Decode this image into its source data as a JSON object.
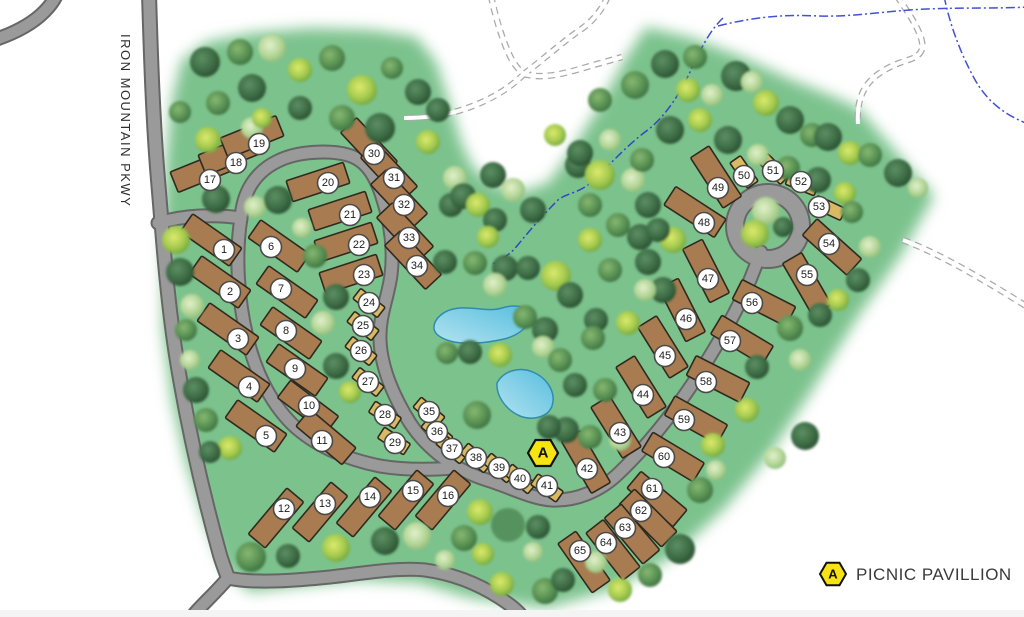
{
  "road_label": "IRON MOUNTAIN PKWY",
  "legend": {
    "letter": "A",
    "label": "PICNIC PAVILLION"
  },
  "pavilion": {
    "letter": "A",
    "x": 543,
    "y": 453
  },
  "colors": {
    "ground_green": "#7cc28d",
    "road_fill": "#9a9a9a",
    "road_casing": "#666666",
    "rv_site": "#a87c50",
    "tent_site": "#d9b964",
    "site_outline": "#2f2a20",
    "pond_fill": "#6fc8e4",
    "pond_edge": "#2f8cb0",
    "stream_blue": "#2233cc",
    "marker_yellow": "#f6e313",
    "badge_fill": "#ffffff",
    "badge_edge": "#4a4a4a"
  },
  "sites": [
    [
      1,
      211,
      240,
      35,
      "rv",
      224,
      250
    ],
    [
      2,
      220,
      282,
      35,
      "rv",
      230,
      292
    ],
    [
      3,
      228,
      329,
      35,
      "rv",
      238,
      339
    ],
    [
      4,
      239,
      376,
      35,
      "rv",
      249,
      387
    ],
    [
      5,
      256,
      426,
      35,
      "rv",
      266,
      436
    ],
    [
      6,
      279,
      246,
      35,
      "rv",
      271,
      247
    ],
    [
      7,
      287,
      292,
      35,
      "rv",
      281,
      289
    ],
    [
      8,
      291,
      333,
      35,
      "rv",
      286,
      331
    ],
    [
      9,
      297,
      370,
      35,
      "rv",
      295,
      369
    ],
    [
      10,
      308,
      407,
      37,
      "rv",
      309,
      406
    ],
    [
      11,
      326,
      437,
      40,
      "rv",
      322,
      441
    ],
    [
      12,
      276,
      518,
      -50,
      "rv",
      284,
      509
    ],
    [
      13,
      320,
      512,
      -50,
      "rv",
      325,
      504
    ],
    [
      14,
      364,
      507,
      -50,
      "rv",
      370,
      497
    ],
    [
      15,
      406,
      500,
      -50,
      "rv",
      413,
      491
    ],
    [
      16,
      443,
      500,
      -50,
      "rv",
      448,
      496
    ],
    [
      17,
      202,
      171,
      -22,
      "rv",
      210,
      180
    ],
    [
      18,
      230,
      154,
      -22,
      "rv",
      236,
      163
    ],
    [
      19,
      252,
      137,
      -22,
      "rv",
      259,
      144
    ],
    [
      20,
      318,
      182,
      -18,
      "rv",
      328,
      183
    ],
    [
      21,
      340,
      211,
      -18,
      "rv",
      350,
      215
    ],
    [
      22,
      346,
      242,
      -18,
      "rv",
      359,
      245
    ],
    [
      23,
      351,
      274,
      -18,
      "rv",
      364,
      275
    ],
    [
      24,
      369,
      303,
      38,
      "tent",
      369,
      303
    ],
    [
      25,
      363,
      326,
      38,
      "tent",
      363,
      326
    ],
    [
      26,
      361,
      351,
      38,
      "tent",
      361,
      351
    ],
    [
      27,
      368,
      382,
      38,
      "tent",
      368,
      382
    ],
    [
      28,
      385,
      415,
      33,
      "tent",
      385,
      415
    ],
    [
      29,
      394,
      441,
      33,
      "tent",
      395,
      443
    ],
    [
      30,
      369,
      147,
      47,
      "rv",
      374,
      154
    ],
    [
      31,
      389,
      172,
      47,
      "rv",
      394,
      178
    ],
    [
      32,
      399,
      199,
      47,
      "rv",
      404,
      205
    ],
    [
      33,
      405,
      232,
      47,
      "rv",
      409,
      238
    ],
    [
      34,
      413,
      260,
      47,
      "rv",
      417,
      266
    ],
    [
      35,
      429,
      412,
      40,
      "tent",
      429,
      412
    ],
    [
      36,
      437,
      432,
      40,
      "tent",
      437,
      432
    ],
    [
      37,
      452,
      449,
      40,
      "tent",
      452,
      449
    ],
    [
      38,
      476,
      458,
      40,
      "tent",
      476,
      458
    ],
    [
      39,
      499,
      468,
      40,
      "tent",
      499,
      468
    ],
    [
      40,
      520,
      479,
      40,
      "tent",
      520,
      479
    ],
    [
      41,
      547,
      488,
      35,
      "tent",
      547,
      486
    ],
    [
      42,
      586,
      462,
      60,
      "rv",
      587,
      469
    ],
    [
      43,
      616,
      427,
      58,
      "rv",
      620,
      433
    ],
    [
      44,
      641,
      387,
      58,
      "rv",
      643,
      395
    ],
    [
      45,
      663,
      347,
      58,
      "rv",
      665,
      356
    ],
    [
      46,
      682,
      310,
      63,
      "rv",
      686,
      319
    ],
    [
      47,
      706,
      271,
      63,
      "rv",
      708,
      279
    ],
    [
      48,
      695,
      212,
      33,
      "rv",
      704,
      223
    ],
    [
      49,
      716,
      177,
      57,
      "rv",
      718,
      188
    ],
    [
      50,
      744,
      172,
      55,
      "tent",
      744,
      176
    ],
    [
      51,
      774,
      169,
      45,
      "tent",
      773,
      171
    ],
    [
      52,
      802,
      184,
      22,
      "tent",
      801,
      182
    ],
    [
      53,
      829,
      208,
      25,
      "tent",
      819,
      207
    ],
    [
      54,
      832,
      247,
      42,
      "rv",
      829,
      244
    ],
    [
      55,
      807,
      284,
      60,
      "rv",
      807,
      275
    ],
    [
      56,
      764,
      303,
      27,
      "rv",
      752,
      303
    ],
    [
      57,
      742,
      340,
      31,
      "rv",
      730,
      341
    ],
    [
      58,
      718,
      379,
      27,
      "rv",
      706,
      382
    ],
    [
      59,
      696,
      420,
      29,
      "rv",
      684,
      420
    ],
    [
      60,
      673,
      457,
      31,
      "rv",
      664,
      457
    ],
    [
      61,
      657,
      499,
      40,
      "rv",
      652,
      489
    ],
    [
      62,
      648,
      518,
      45,
      "rv",
      641,
      511
    ],
    [
      63,
      632,
      534,
      50,
      "rv",
      625,
      528
    ],
    [
      64,
      613,
      550,
      52,
      "rv",
      606,
      543
    ],
    [
      65,
      584,
      562,
      55,
      "rv",
      580,
      551
    ]
  ],
  "trees": [
    [
      205,
      62,
      15,
      "d"
    ],
    [
      240,
      52,
      13,
      "m"
    ],
    [
      272,
      48,
      14,
      "l"
    ],
    [
      300,
      70,
      12,
      "y"
    ],
    [
      332,
      58,
      13,
      "m"
    ],
    [
      362,
      90,
      15,
      "y"
    ],
    [
      392,
      68,
      11,
      "m"
    ],
    [
      418,
      92,
      13,
      "d"
    ],
    [
      252,
      88,
      14,
      "d"
    ],
    [
      218,
      103,
      12,
      "m"
    ],
    [
      300,
      108,
      12,
      "d"
    ],
    [
      342,
      118,
      13,
      "m"
    ],
    [
      380,
      128,
      15,
      "d"
    ],
    [
      428,
      142,
      12,
      "y"
    ],
    [
      438,
      110,
      12,
      "d"
    ],
    [
      252,
      128,
      11,
      "l"
    ],
    [
      208,
      140,
      13,
      "y"
    ],
    [
      180,
      112,
      11,
      "m"
    ],
    [
      262,
      118,
      10,
      "y"
    ],
    [
      216,
      199,
      14,
      "d"
    ],
    [
      255,
      207,
      11,
      "l"
    ],
    [
      278,
      200,
      14,
      "d"
    ],
    [
      451,
      205,
      12,
      "d"
    ],
    [
      176,
      240,
      14,
      "y"
    ],
    [
      180,
      272,
      14,
      "d"
    ],
    [
      192,
      306,
      12,
      "l"
    ],
    [
      186,
      330,
      11,
      "m"
    ],
    [
      190,
      360,
      10,
      "l"
    ],
    [
      196,
      390,
      13,
      "d"
    ],
    [
      206,
      420,
      12,
      "m"
    ],
    [
      230,
      448,
      12,
      "y"
    ],
    [
      210,
      452,
      11,
      "d"
    ],
    [
      315,
      256,
      12,
      "m"
    ],
    [
      336,
      297,
      13,
      "d"
    ],
    [
      323,
      323,
      12,
      "l"
    ],
    [
      336,
      366,
      13,
      "d"
    ],
    [
      350,
      392,
      11,
      "y"
    ],
    [
      302,
      228,
      10,
      "l"
    ],
    [
      251,
      557,
      15,
      "m"
    ],
    [
      288,
      556,
      12,
      "d"
    ],
    [
      336,
      548,
      14,
      "y"
    ],
    [
      385,
      541,
      14,
      "d"
    ],
    [
      417,
      536,
      14,
      "l"
    ],
    [
      464,
      538,
      13,
      "m"
    ],
    [
      483,
      554,
      11,
      "y"
    ],
    [
      480,
      512,
      13,
      "y"
    ],
    [
      538,
      527,
      12,
      "d"
    ],
    [
      533,
      552,
      10,
      "l"
    ],
    [
      545,
      591,
      13,
      "m"
    ],
    [
      502,
      584,
      12,
      "y"
    ],
    [
      563,
      580,
      12,
      "d"
    ],
    [
      445,
      560,
      10,
      "l"
    ],
    [
      455,
      178,
      12,
      "l"
    ],
    [
      463,
      196,
      13,
      "d"
    ],
    [
      478,
      205,
      12,
      "y"
    ],
    [
      493,
      175,
      13,
      "d"
    ],
    [
      513,
      190,
      12,
      "l"
    ],
    [
      533,
      210,
      13,
      "d"
    ],
    [
      495,
      220,
      12,
      "d"
    ],
    [
      488,
      237,
      11,
      "y"
    ],
    [
      578,
      165,
      13,
      "d"
    ],
    [
      600,
      175,
      15,
      "y"
    ],
    [
      633,
      180,
      12,
      "l"
    ],
    [
      648,
      205,
      13,
      "d"
    ],
    [
      590,
      205,
      12,
      "m"
    ],
    [
      618,
      225,
      12,
      "m"
    ],
    [
      640,
      237,
      13,
      "d"
    ],
    [
      673,
      240,
      13,
      "y"
    ],
    [
      590,
      240,
      12,
      "y"
    ],
    [
      556,
      276,
      15,
      "y"
    ],
    [
      505,
      268,
      13,
      "d"
    ],
    [
      475,
      263,
      12,
      "m"
    ],
    [
      445,
      262,
      12,
      "d"
    ],
    [
      495,
      285,
      12,
      "l"
    ],
    [
      528,
      268,
      12,
      "d"
    ],
    [
      570,
      295,
      13,
      "d"
    ],
    [
      610,
      270,
      12,
      "m"
    ],
    [
      648,
      262,
      13,
      "d"
    ],
    [
      663,
      290,
      13,
      "d"
    ],
    [
      645,
      290,
      11,
      "l"
    ],
    [
      525,
      317,
      12,
      "m"
    ],
    [
      545,
      330,
      13,
      "d"
    ],
    [
      596,
      320,
      12,
      "d"
    ],
    [
      628,
      323,
      12,
      "y"
    ],
    [
      593,
      338,
      12,
      "m"
    ],
    [
      543,
      347,
      11,
      "l"
    ],
    [
      500,
      355,
      12,
      "y"
    ],
    [
      470,
      352,
      12,
      "d"
    ],
    [
      447,
      353,
      11,
      "m"
    ],
    [
      560,
      360,
      12,
      "m"
    ],
    [
      575,
      385,
      12,
      "d"
    ],
    [
      605,
      390,
      12,
      "m"
    ],
    [
      566,
      430,
      13,
      "d"
    ],
    [
      590,
      437,
      12,
      "m"
    ],
    [
      549,
      427,
      12,
      "d"
    ],
    [
      477,
      415,
      14,
      "m"
    ],
    [
      620,
      440,
      11,
      "l"
    ],
    [
      665,
      64,
      14,
      "d"
    ],
    [
      695,
      57,
      12,
      "m"
    ],
    [
      736,
      76,
      15,
      "d"
    ],
    [
      752,
      82,
      11,
      "l"
    ],
    [
      766,
      103,
      13,
      "y"
    ],
    [
      790,
      120,
      14,
      "d"
    ],
    [
      812,
      135,
      12,
      "m"
    ],
    [
      828,
      137,
      14,
      "d"
    ],
    [
      850,
      153,
      12,
      "y"
    ],
    [
      870,
      155,
      12,
      "m"
    ],
    [
      898,
      173,
      14,
      "d"
    ],
    [
      918,
      188,
      10,
      "l"
    ],
    [
      635,
      85,
      14,
      "m"
    ],
    [
      600,
      100,
      12,
      "m"
    ],
    [
      555,
      135,
      11,
      "y"
    ],
    [
      580,
      153,
      13,
      "d"
    ],
    [
      610,
      140,
      11,
      "l"
    ],
    [
      642,
      160,
      12,
      "m"
    ],
    [
      670,
      130,
      14,
      "d"
    ],
    [
      700,
      120,
      12,
      "y"
    ],
    [
      728,
      140,
      14,
      "d"
    ],
    [
      758,
      155,
      11,
      "l"
    ],
    [
      788,
      168,
      12,
      "m"
    ],
    [
      818,
      180,
      13,
      "d"
    ],
    [
      845,
      193,
      11,
      "y"
    ],
    [
      688,
      90,
      12,
      "y"
    ],
    [
      712,
      95,
      11,
      "l"
    ],
    [
      766,
      211,
      14,
      "l"
    ],
    [
      755,
      234,
      14,
      "y"
    ],
    [
      783,
      227,
      10,
      "d"
    ],
    [
      852,
      212,
      11,
      "m"
    ],
    [
      870,
      247,
      11,
      "l"
    ],
    [
      858,
      280,
      12,
      "d"
    ],
    [
      838,
      300,
      11,
      "y"
    ],
    [
      820,
      315,
      12,
      "d"
    ],
    [
      790,
      328,
      13,
      "m"
    ],
    [
      757,
      367,
      12,
      "d"
    ],
    [
      800,
      360,
      11,
      "l"
    ],
    [
      747,
      410,
      12,
      "y"
    ],
    [
      805,
      436,
      14,
      "d"
    ],
    [
      775,
      458,
      11,
      "l"
    ],
    [
      658,
      230,
      12,
      "d"
    ],
    [
      680,
      549,
      15,
      "d"
    ],
    [
      700,
      490,
      13,
      "m"
    ],
    [
      713,
      445,
      12,
      "y"
    ],
    [
      716,
      470,
      10,
      "l"
    ],
    [
      650,
      575,
      12,
      "m"
    ],
    [
      620,
      590,
      12,
      "y"
    ],
    [
      596,
      562,
      11,
      "l"
    ]
  ],
  "flat_tree": [
    508,
    525,
    17
  ]
}
